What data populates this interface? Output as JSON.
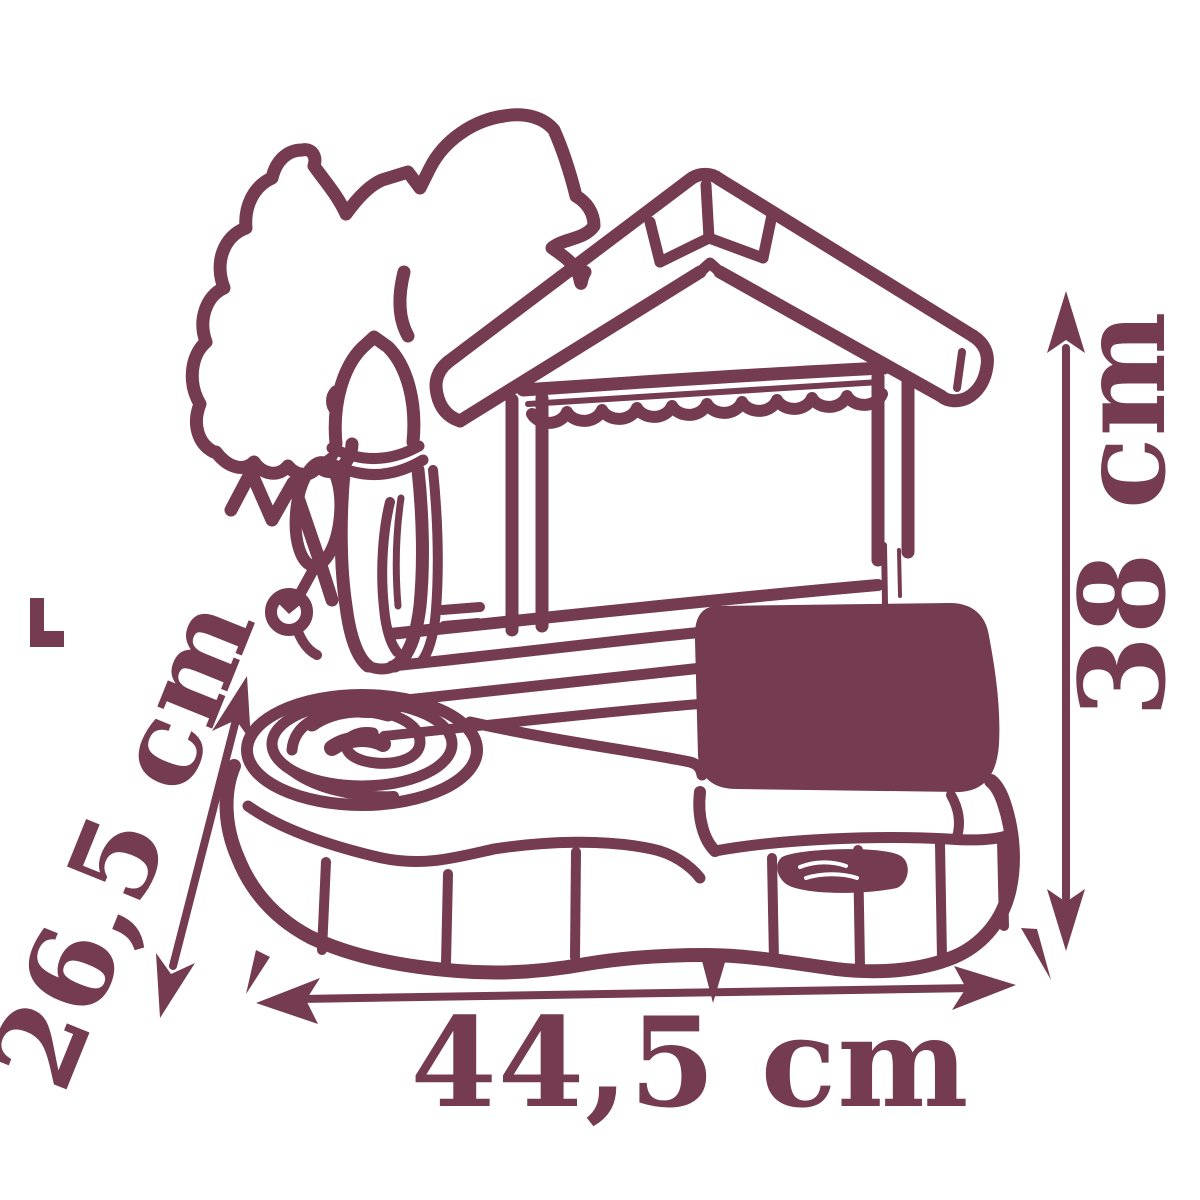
{
  "meta": {
    "description": "Burgundy line-art dimension diagram of a toy play table with palm tree, water tower, canopy roof, swirl basin and brick base"
  },
  "colors": {
    "ink": "#743b51",
    "bg": "#ffffff"
  },
  "dimensions": {
    "height_label": "38 cm",
    "depth_label": "26,5 cm",
    "width_label": "44,5 cm"
  }
}
